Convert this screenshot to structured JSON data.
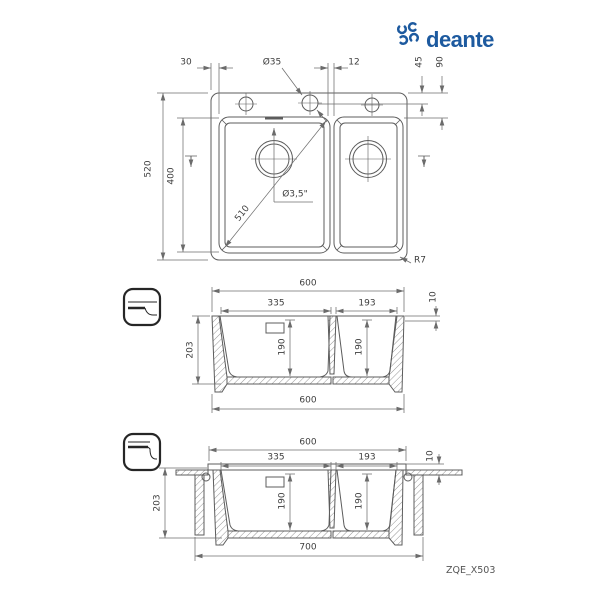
{
  "brand": {
    "name": "deante"
  },
  "model_code": "ZQE_X503",
  "colors": {
    "brand_blue": "#1d5a9f",
    "line": "#5c5c5c",
    "dim_line": "#6f6f6f",
    "text": "#3d3d3d"
  },
  "top_view": {
    "edge_offset": "30",
    "hole_diameter": "Ø35",
    "hole_spacing": "12",
    "hole_center_offset": "45",
    "bowl_top_offset": "90",
    "overall_depth": "520",
    "bowl_length": "400",
    "bowl_diagonal": "510",
    "drain_size": "Ø3,5\"",
    "corner_radius": "R7"
  },
  "section_view": {
    "width_top": "600",
    "left_bowl_width": "335",
    "right_bowl_width": "193",
    "rim_height": "10",
    "total_height": "203",
    "left_bowl_depth": "190",
    "right_bowl_depth": "190",
    "width_bottom": "600"
  },
  "installed_view": {
    "width_top": "600",
    "left_bowl_width": "335",
    "right_bowl_width": "193",
    "rim_height": "10",
    "total_height": "203",
    "left_bowl_depth": "190",
    "right_bowl_depth": "190",
    "cabinet_min_width": "700"
  }
}
